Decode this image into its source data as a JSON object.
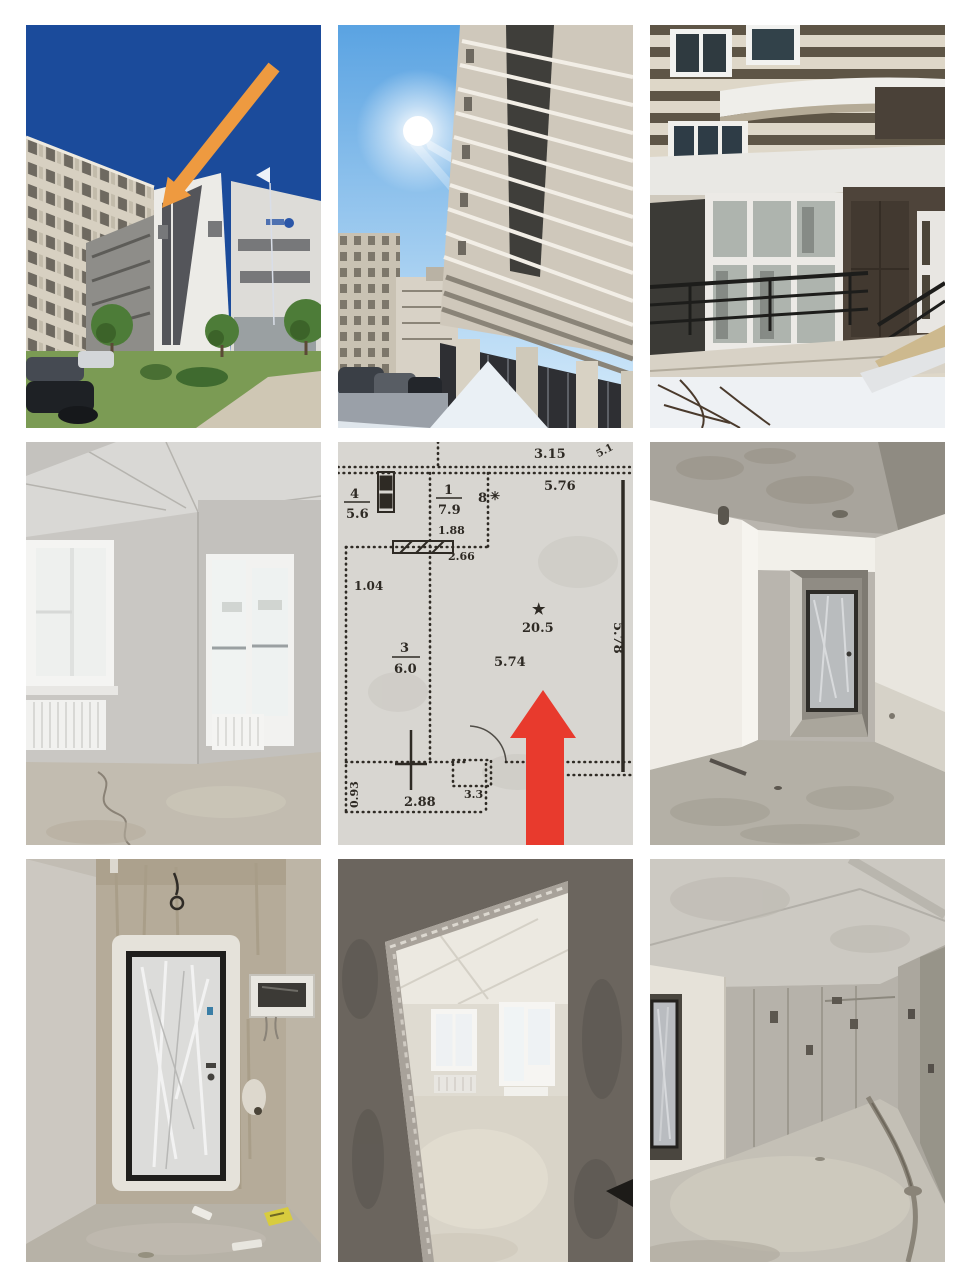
{
  "page": {
    "background": "#ffffff"
  },
  "colors": {
    "deep_blue_sky": "#1b4b9b",
    "light_sky": "#69aee6",
    "orange_arrow": "#ee9a40",
    "red_arrow": "#e83a2d",
    "plan_paper": "#d8d6d1",
    "plan_ink": "#2e2a24"
  },
  "floorplan": {
    "labels": {
      "dim_top_a": "3.15",
      "dim_top_b": "5.76",
      "dim_corner": "5.1",
      "room4_no": "4",
      "room4_area": "5.6",
      "room1_no": "1",
      "room1_area": "7.9",
      "dim_door": "1.88",
      "mark_8": "8",
      "star_small": "✳",
      "dim_inner": "2.66",
      "dim_small": "1.04",
      "room3_no": "3",
      "room3_area": "6.0",
      "dim_room_w": "5.74",
      "room2_star": "★",
      "room2_area": "20.5",
      "dim_right_v": "5.78",
      "dim_left_v": "0.93",
      "dim_bottom_a": "2.88",
      "dim_bottom_b": "3.3"
    }
  }
}
